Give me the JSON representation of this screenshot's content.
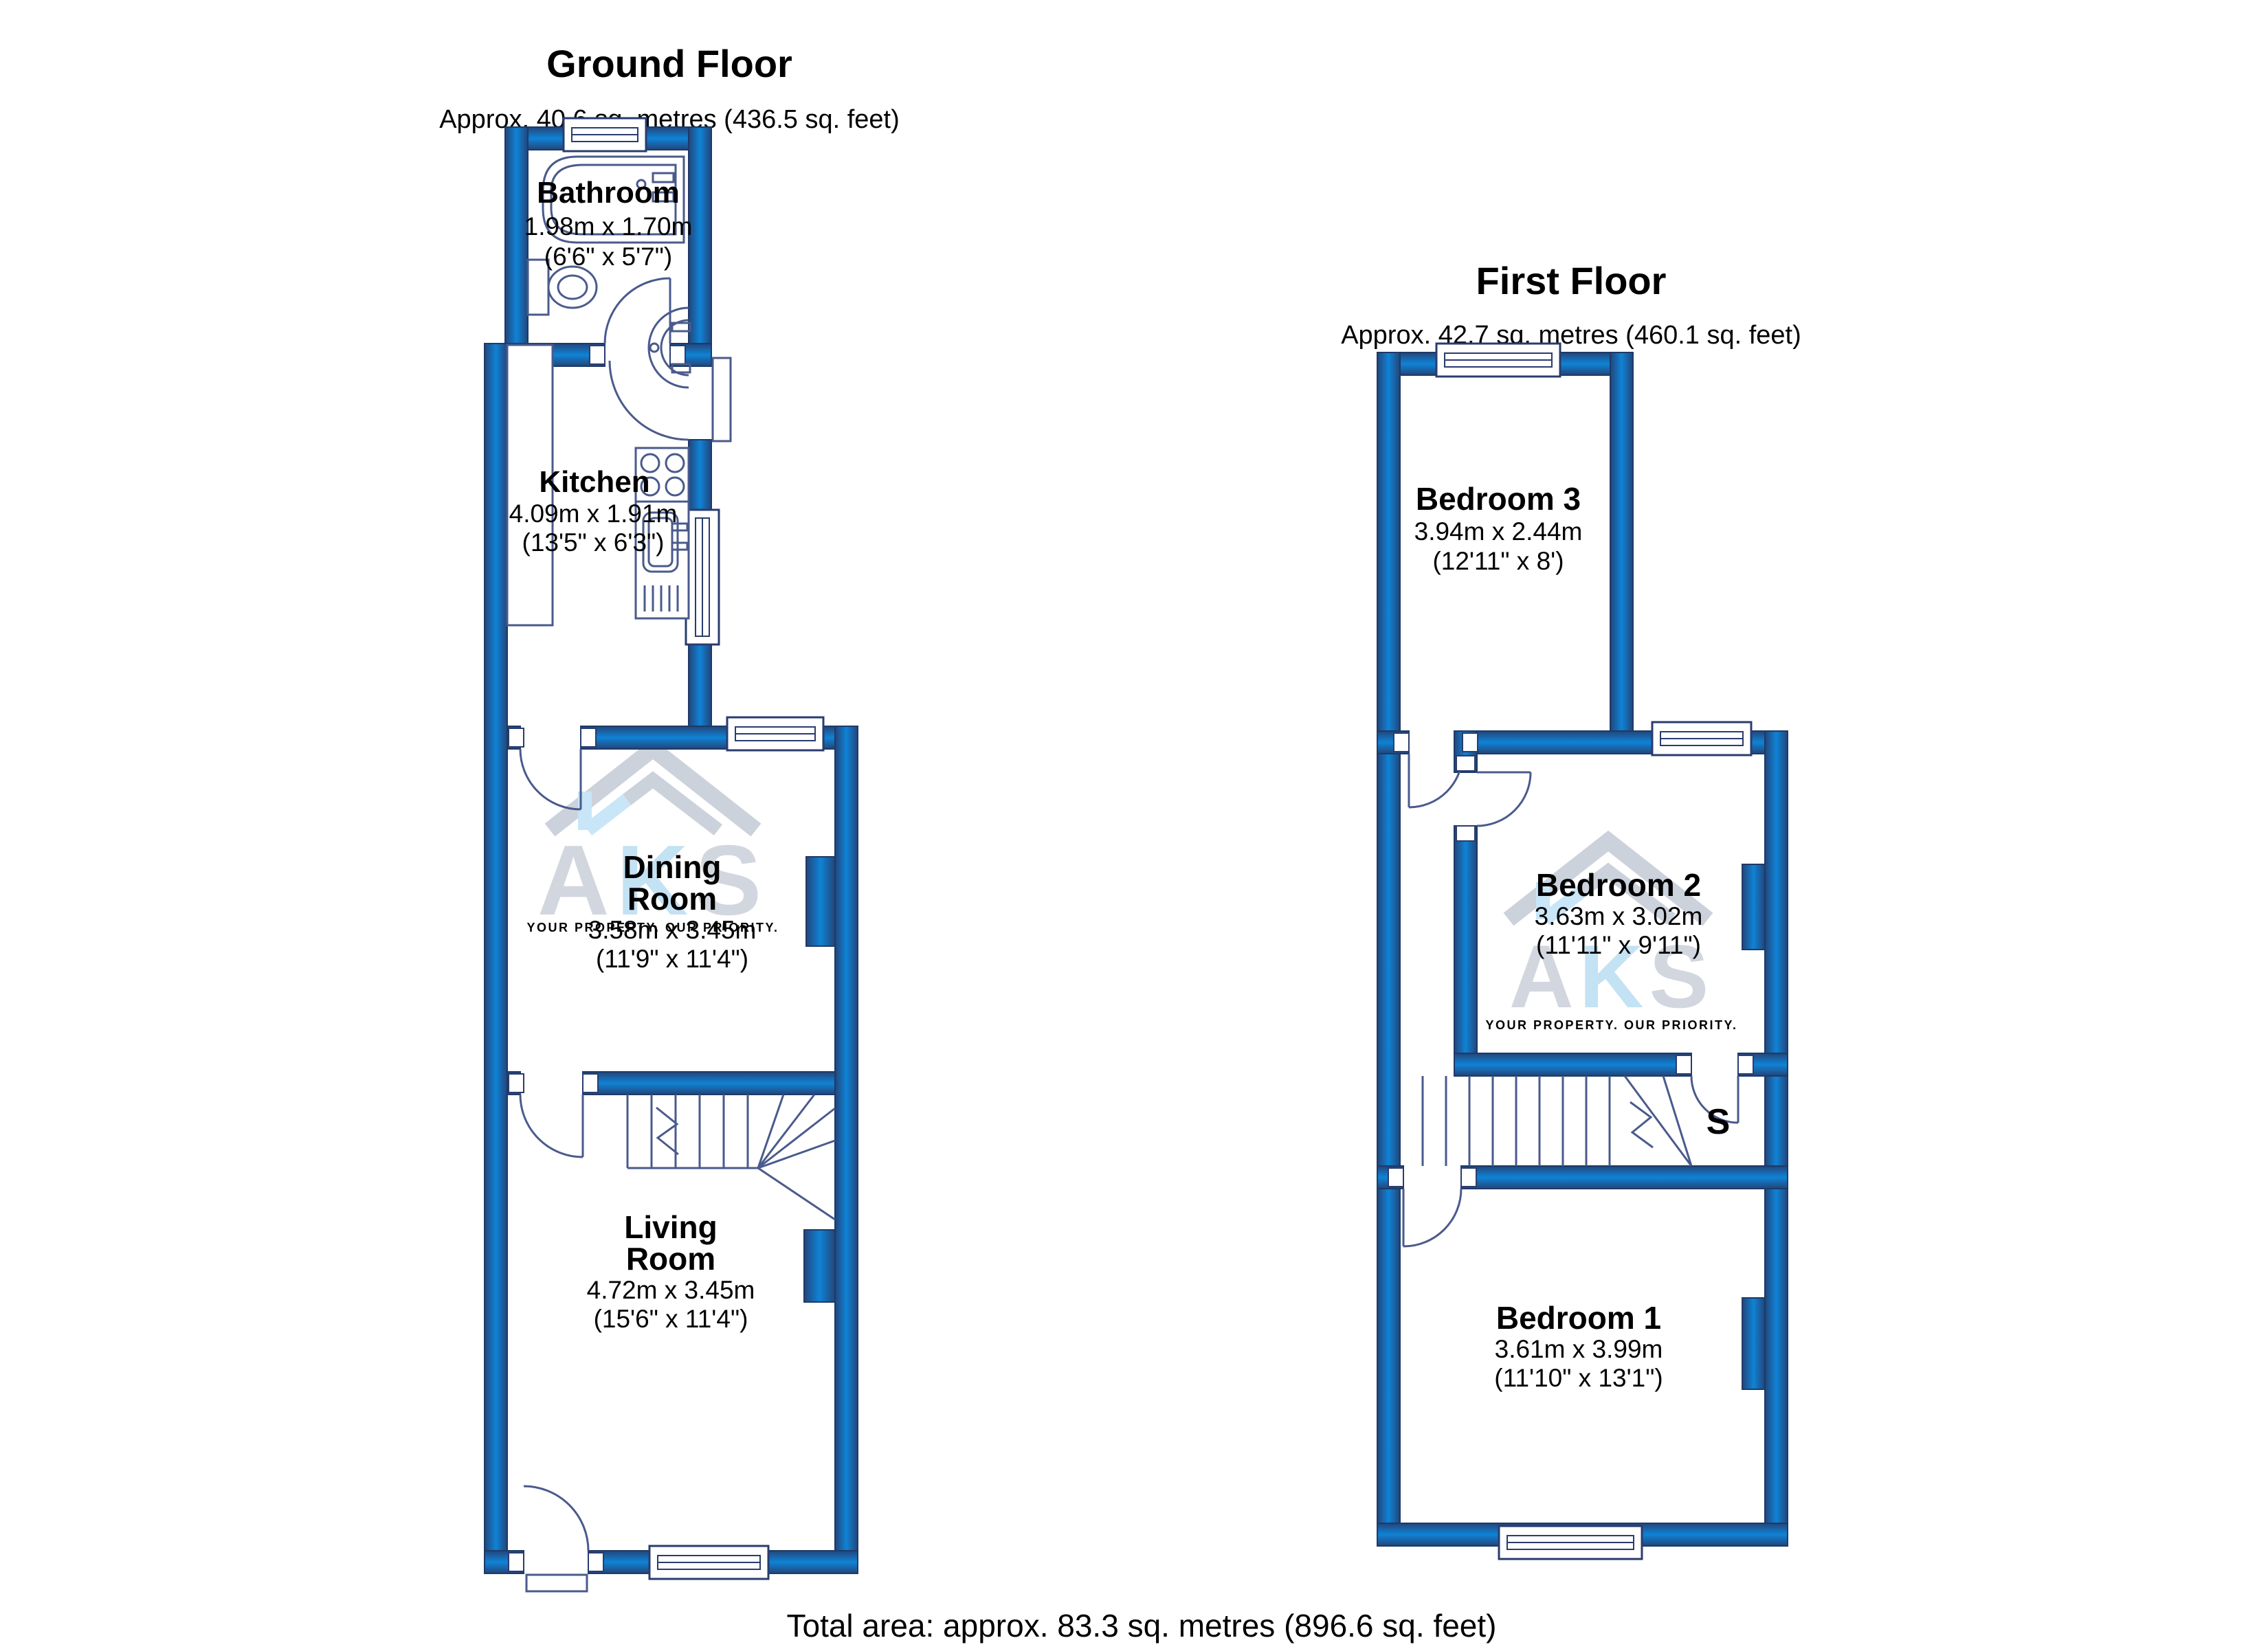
{
  "page": {
    "footer": "Total area: approx. 83.3 sq. metres (896.6 sq. feet)"
  },
  "branding": {
    "letter_a": "A",
    "letter_k": "K",
    "letter_s": "S",
    "slogan": "YOUR PROPERTY. OUR PRIORITY."
  },
  "ground_floor": {
    "title": "Ground Floor",
    "subtitle": "Approx. 40.6 sq. metres (436.5 sq. feet)",
    "rooms": {
      "bathroom": {
        "name": "Bathroom",
        "metric": "1.98m x 1.70m",
        "imperial": "(6'6\" x 5'7\")"
      },
      "kitchen": {
        "name": "Kitchen",
        "metric": "4.09m x 1.91m",
        "imperial": "(13'5\" x 6'3\")"
      },
      "dining": {
        "name_line1": "Dining",
        "name_line2": "Room",
        "metric": "3.58m x 3.45m",
        "imperial": "(11'9\" x 11'4\")"
      },
      "living": {
        "name_line1": "Living",
        "name_line2": "Room",
        "metric": "4.72m x 3.45m",
        "imperial": "(15'6\" x 11'4\")"
      }
    }
  },
  "first_floor": {
    "title": "First Floor",
    "subtitle": "Approx. 42.7 sq. metres (460.1 sq. feet)",
    "rooms": {
      "bedroom3": {
        "name": "Bedroom 3",
        "metric": "3.94m x 2.44m",
        "imperial": "(12'11\" x 8')"
      },
      "bedroom2": {
        "name": "Bedroom 2",
        "metric": "3.63m x 3.02m",
        "imperial": "(11'11\" x 9'11\")"
      },
      "bedroom1": {
        "name": "Bedroom 1",
        "metric": "3.61m x 3.99m",
        "imperial": "(11'10\" x 13'1\")"
      },
      "storage": {
        "label": "S"
      }
    }
  },
  "colors": {
    "wall_core": "#0f83d6",
    "wall_edge": "#23457a",
    "line": "#4a5a8c",
    "watermark_gray": "#d2d6de",
    "watermark_blue": "#c3e2f4",
    "watermark_text": "#c9ced7",
    "text": "#000000"
  }
}
